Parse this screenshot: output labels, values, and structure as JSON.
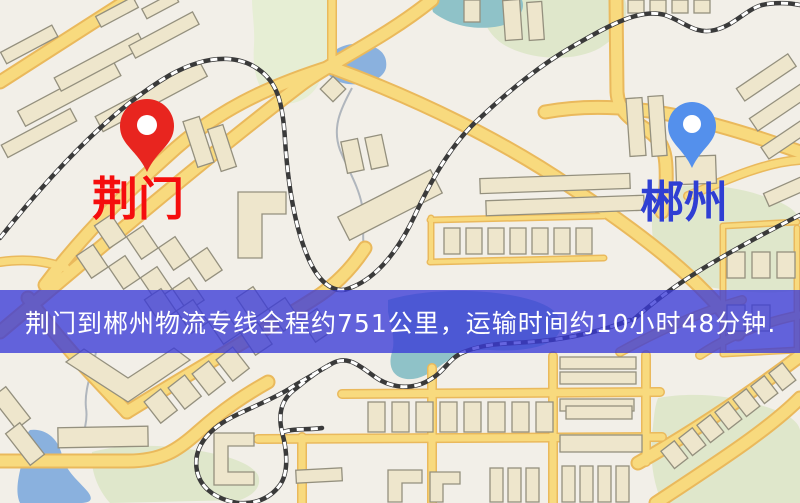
{
  "map": {
    "origin_marker": {
      "label": "荆门",
      "icon": "red-map-pin",
      "pin_color": "#e8251f",
      "label_color": "#f50d0d"
    },
    "destination_marker": {
      "label": "郴州",
      "icon": "blue-map-pin",
      "pin_color": "#5490ec",
      "label_color": "#2f3fd3"
    },
    "banner": {
      "text": "荆门到郴州物流专线全程约751公里，运输时间约10小时48分钟.",
      "background": "rgba(58,58,215,0.78)",
      "text_color": "#ffffff"
    },
    "colors": {
      "land": "#f2efe8",
      "greenery": "#dfe7cb",
      "water_blue": "#8ab1de",
      "water_teal": "#8fc2c8",
      "road_fill": "#f8da7e",
      "road_casing": "#eab95c",
      "building_fill": "#eee6cc",
      "building_stroke": "#94907e",
      "railway": "#3a3a3a"
    }
  }
}
